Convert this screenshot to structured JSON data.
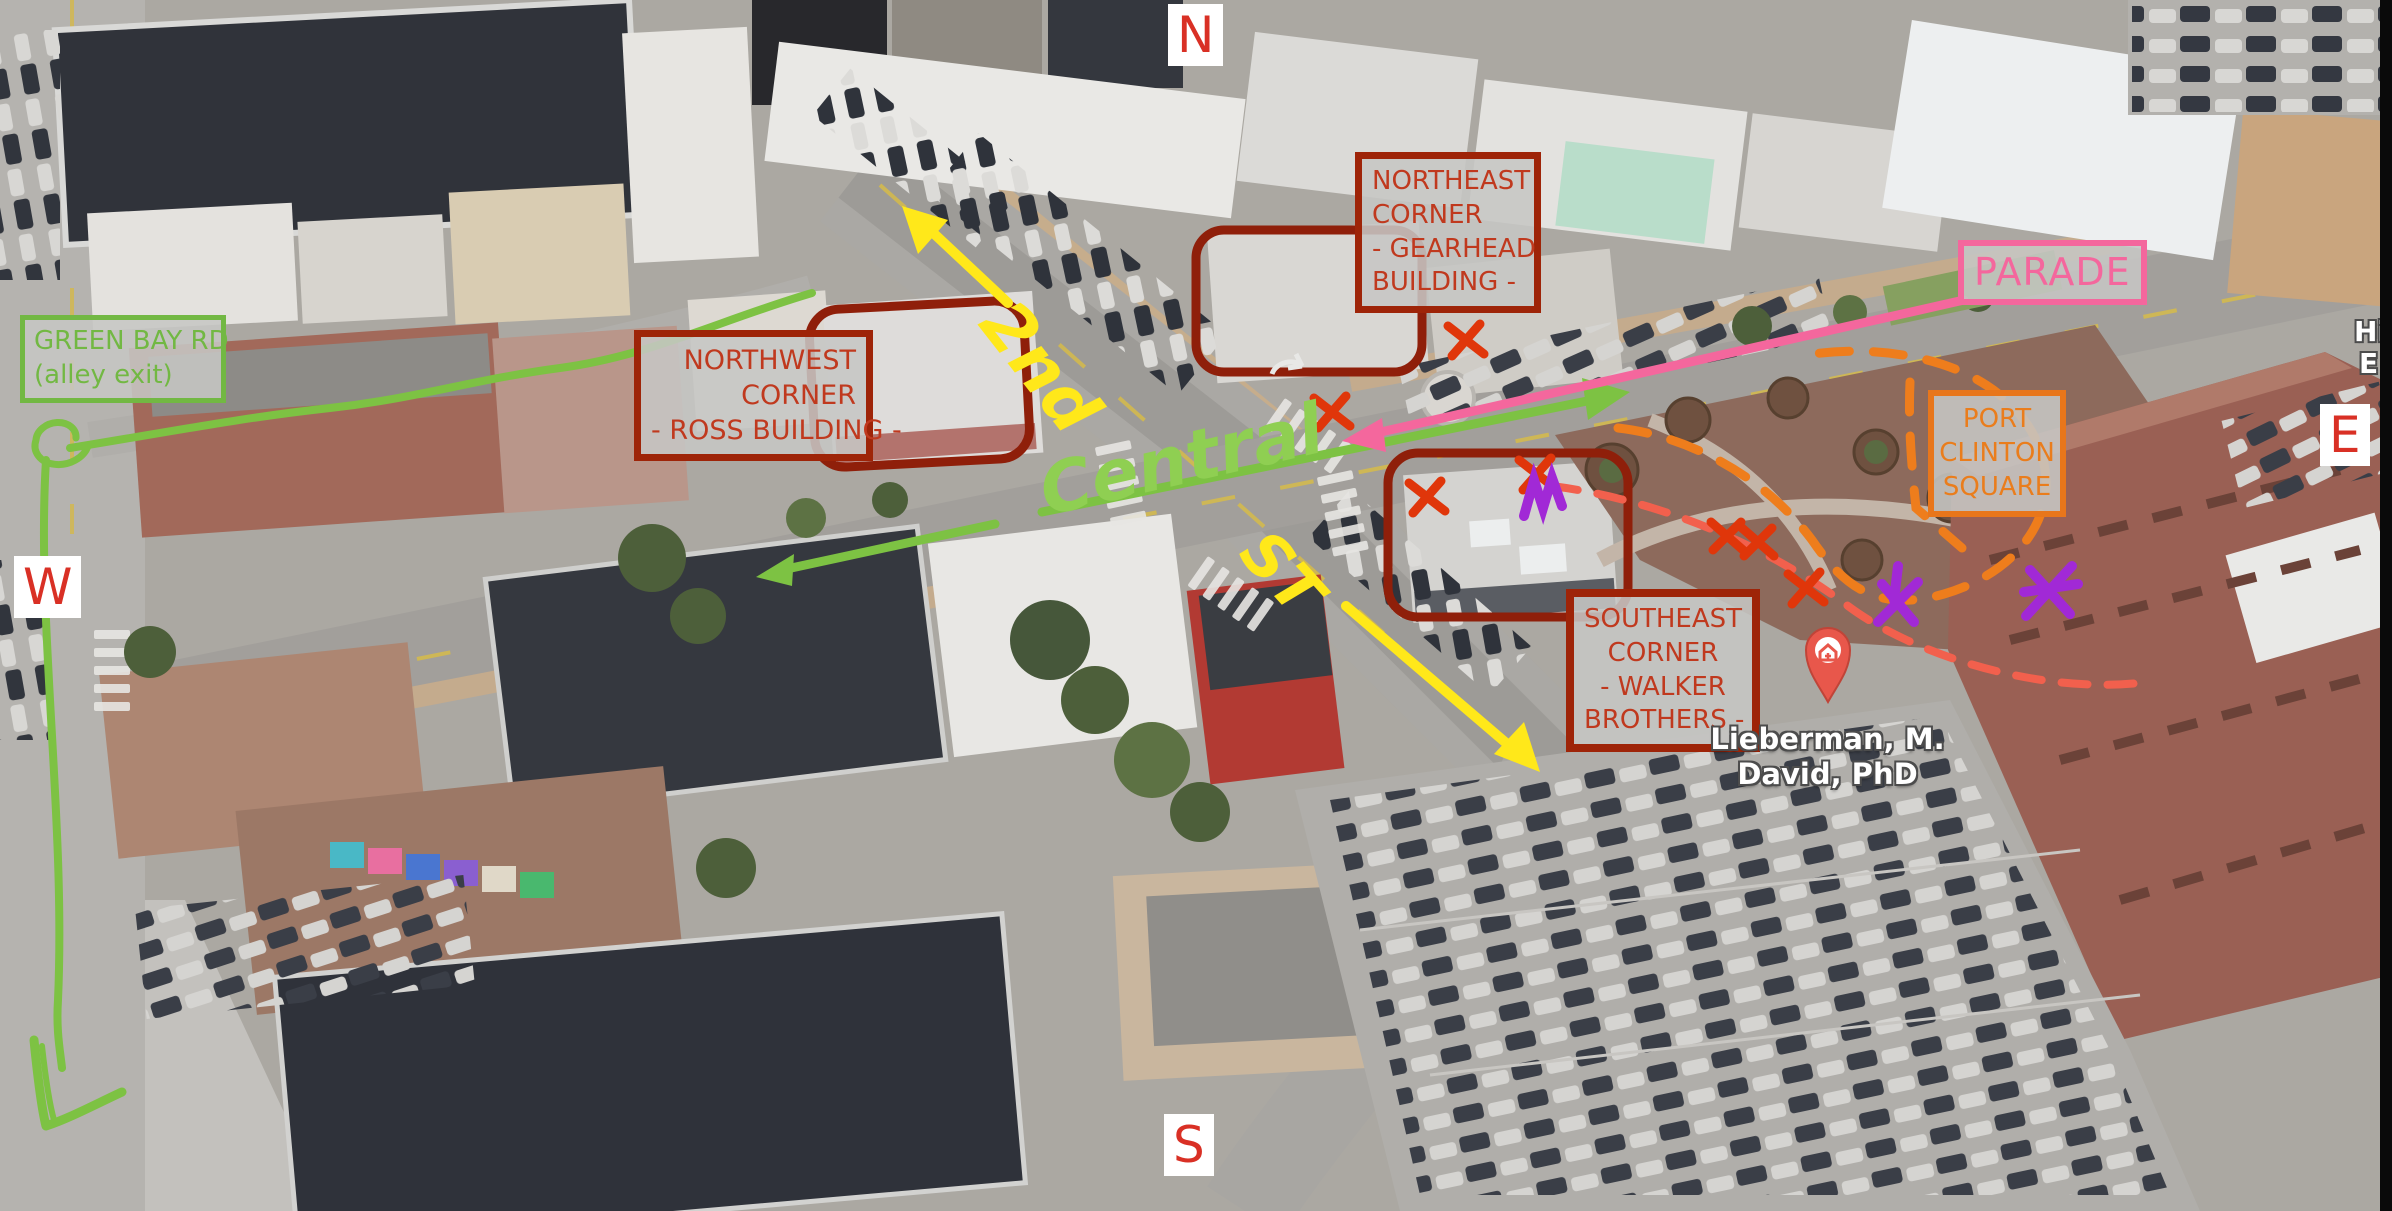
{
  "palette": {
    "label_red_text": "#c0391e",
    "label_red_border": "#9e2408",
    "green": "#7dc243",
    "yellow": "#ffe81a",
    "pink": "#f4679d",
    "orange": "#ee7d1c",
    "salmon": "#f2604d",
    "red_x": "#e0360a",
    "purple": "#a129d6",
    "compass_red": "#d93025",
    "label_bg_gray": "#c6c6c4",
    "poi_pin_red": "#e8574b"
  },
  "compass": {
    "north": "N",
    "west": "W",
    "east": "E",
    "south": "S"
  },
  "boxed_labels": {
    "green_bay": {
      "line1": "GREEN BAY RD",
      "line2": "(alley exit)"
    },
    "northwest": {
      "line1": "NORTHWEST",
      "line2": "CORNER",
      "line3": "- ROSS BUILDING -"
    },
    "northeast": {
      "line1": "NORTHEAST",
      "line2": "CORNER",
      "line3": "- GEARHEAD",
      "line4": "BUILDING -"
    },
    "southeast": {
      "line1": "SOUTHEAST",
      "line2": "CORNER",
      "line3": "- WALKER",
      "line4": "BROTHERS -"
    },
    "port_clinton": {
      "line1": "PORT",
      "line2": "CLINTON",
      "line3": "SQUARE"
    },
    "parade": {
      "text": "PARADE"
    }
  },
  "handwritten_streets": {
    "second": "2nd",
    "central": "Central",
    "st": "ST"
  },
  "map_poi": {
    "line1": "Lieberman, M.",
    "line2": "David, PhD"
  },
  "edge_poi": {
    "line1": "Hi",
    "line2": "E"
  },
  "annotation_marks": {
    "red_x_count": 7,
    "purple_mark_count": 3,
    "routes": [
      "parade-route-pink",
      "alley-exit-route-green",
      "second-st-arrows-yellow",
      "port-clinton-loop-orange-dashed",
      "secondary-path-salmon-dashed"
    ]
  }
}
